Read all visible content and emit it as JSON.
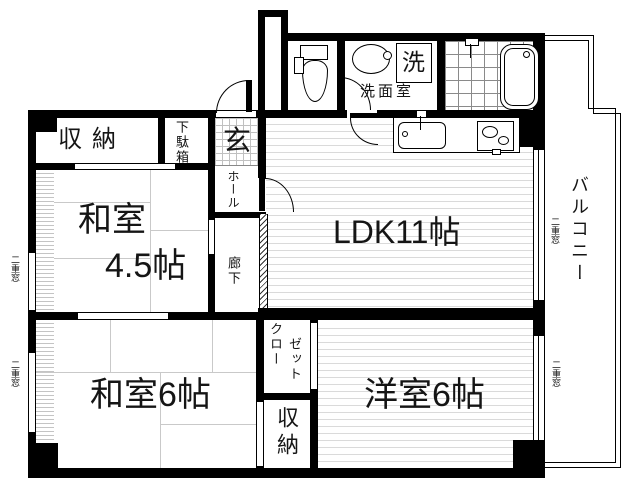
{
  "floorplan": {
    "rooms": {
      "storage_top": "収納",
      "shoe_cabinet": "下駄箱",
      "entrance": "玄",
      "hall": "ホール",
      "corridor": "廊下",
      "japanese_room_small_name": "和室",
      "japanese_room_small_size": "4.5帖",
      "ldk": "LDK11帖",
      "japanese_room_6": "和室6帖",
      "western_room_6": "洋室6帖",
      "washroom": "洗面室",
      "washing_machine": "洗",
      "closet_col1": "クロー",
      "closet_col2": "ゼット",
      "storage_bottom": "収納",
      "balcony": "バルコニー"
    },
    "labels": {
      "double_window": "二重窓"
    },
    "colors": {
      "wall": "#000000",
      "floor_line": "#d9d9d9",
      "tatami_line": "#c9c9c9",
      "background": "#ffffff"
    }
  }
}
